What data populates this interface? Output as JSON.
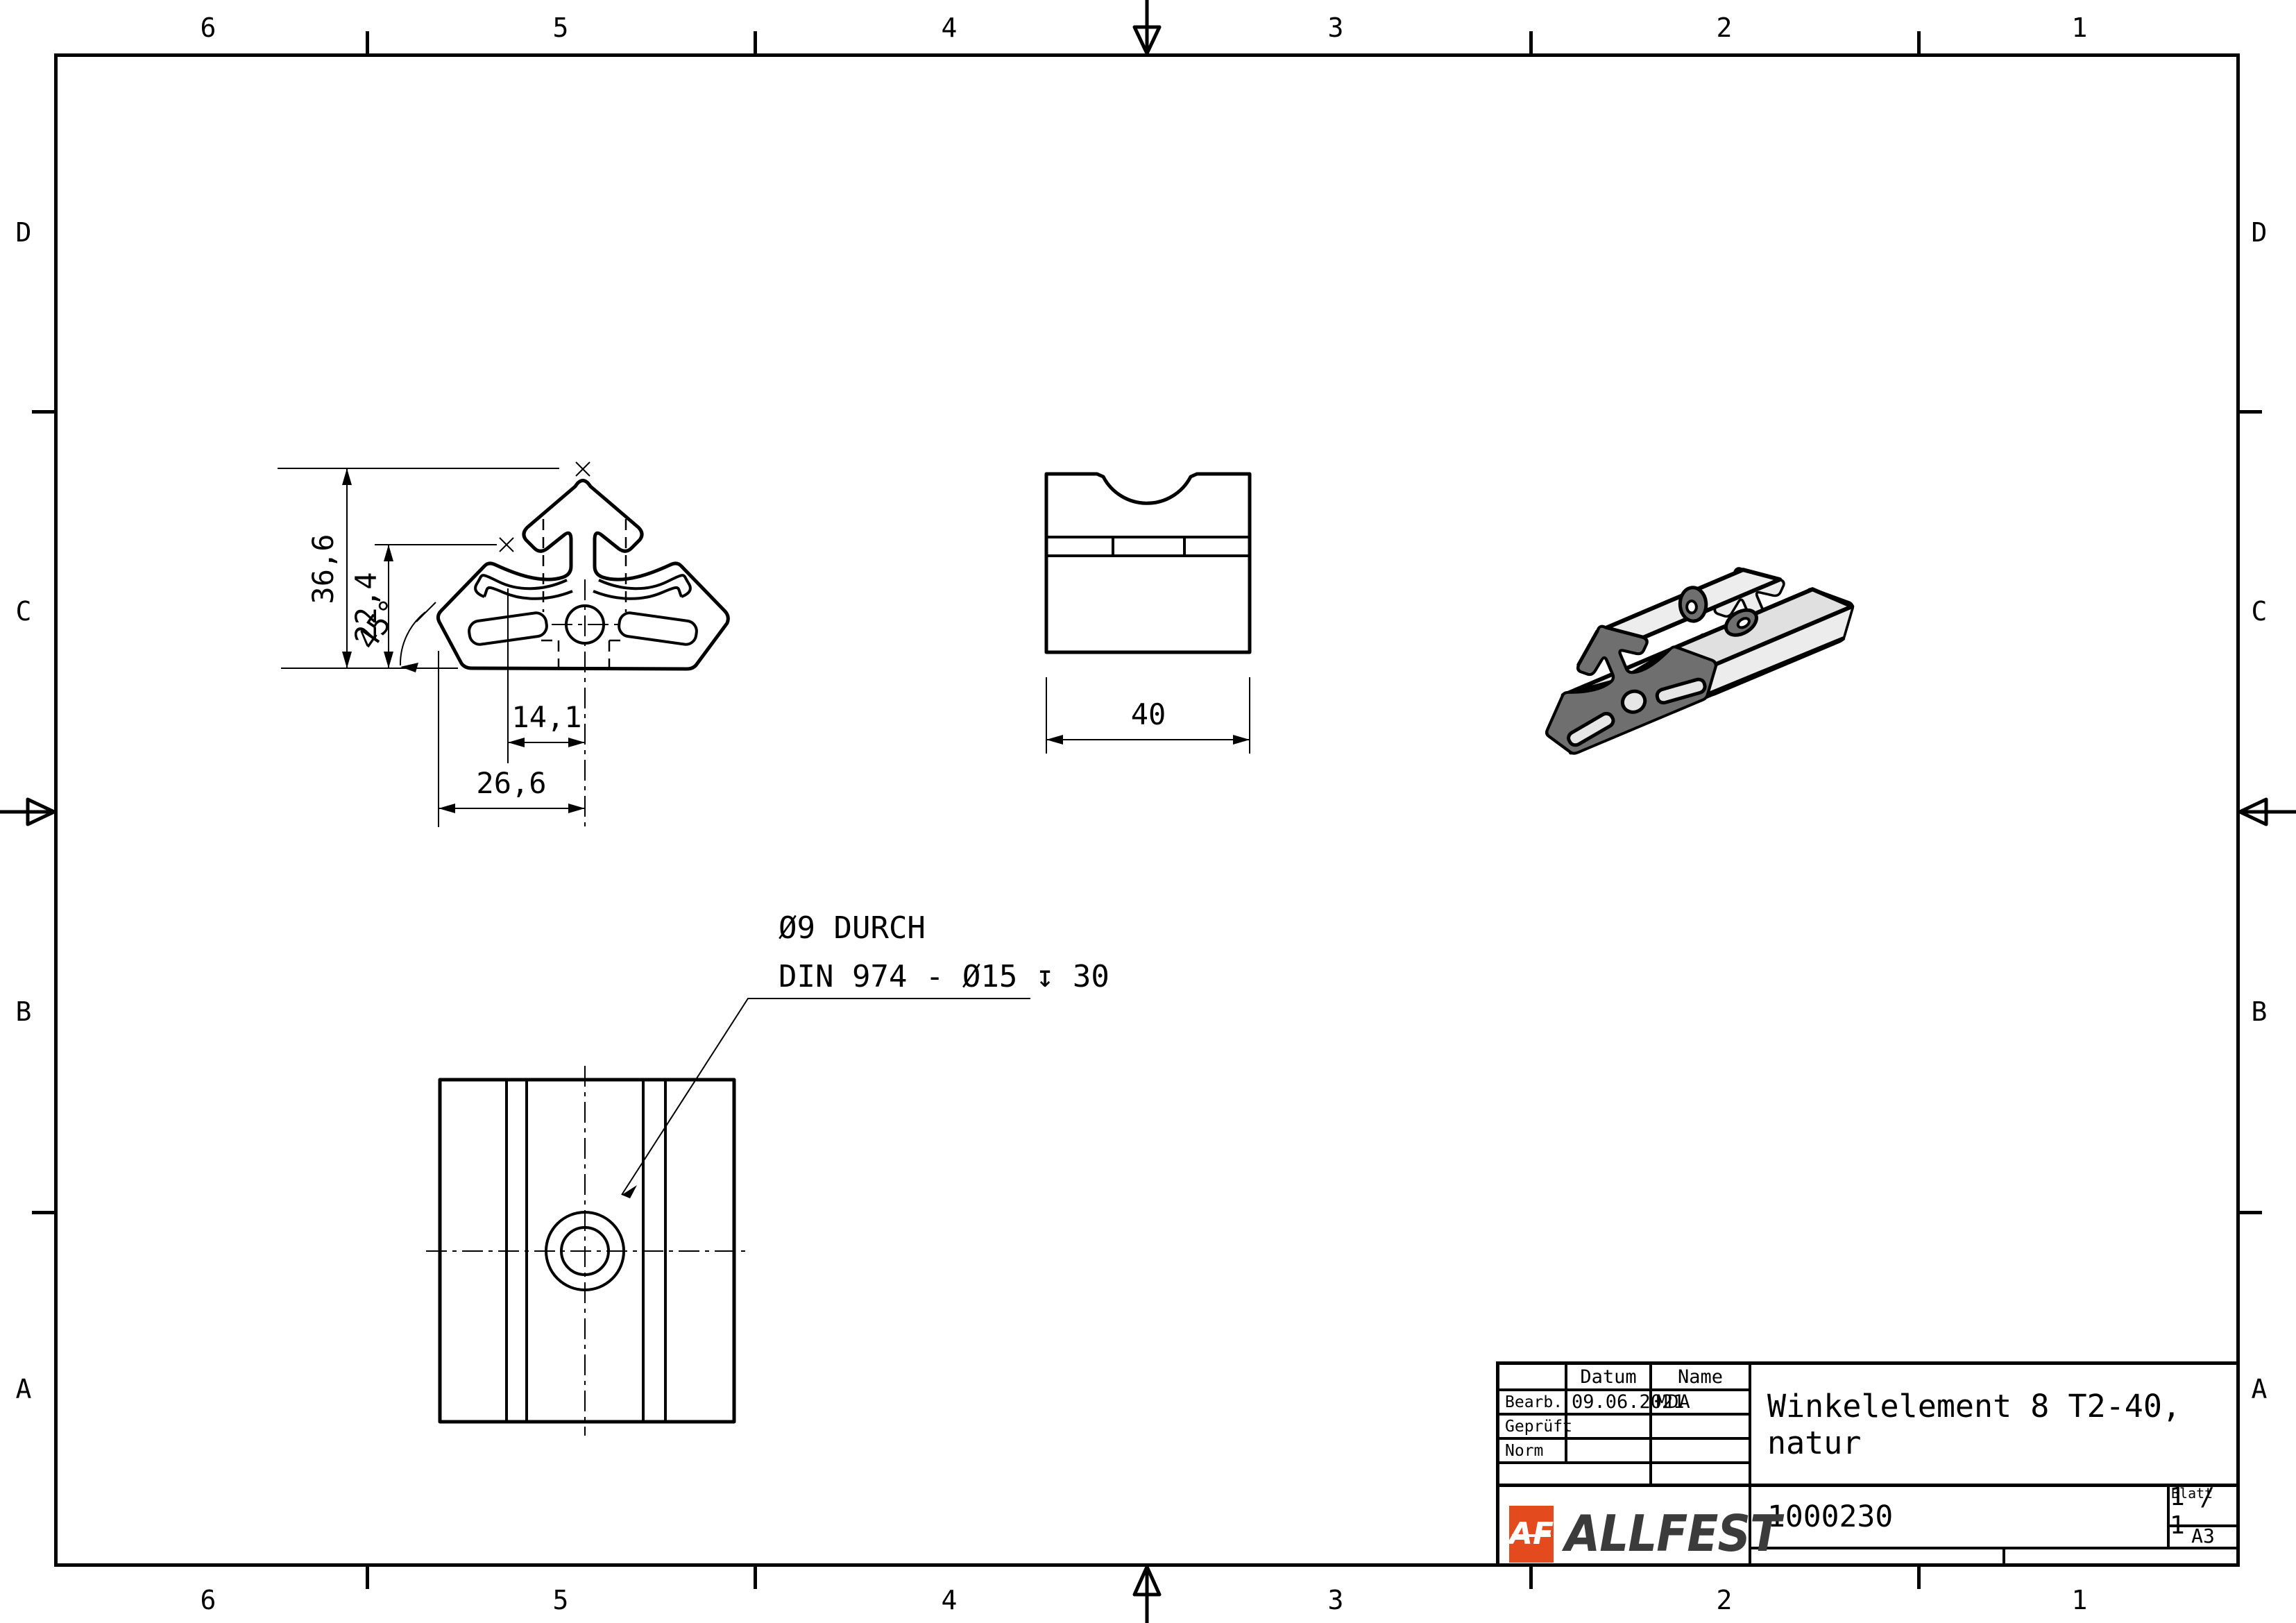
{
  "zones": {
    "columns": [
      "6",
      "5",
      "4",
      "3",
      "2",
      "1"
    ],
    "rows": [
      "D",
      "C",
      "B",
      "A"
    ]
  },
  "views": {
    "section": {
      "dims": {
        "h_total": "36,6",
        "h_slot": "22,4",
        "angle": "45°",
        "w_hole": "14,1",
        "w_total": "26,6"
      }
    },
    "front": {
      "dim_width": "40"
    },
    "bottom": {
      "callout_line1": "Ø9 DURCH",
      "callout_line2": "DIN 974 - Ø15 ↧ 30"
    }
  },
  "titleblock": {
    "headers": {
      "datum": "Datum",
      "name": "Name"
    },
    "rows": [
      {
        "label": "Bearb.",
        "datum": "09.06.2021",
        "name": "MDA"
      },
      {
        "label": "Geprüft",
        "datum": "",
        "name": ""
      },
      {
        "label": "Norm",
        "datum": "",
        "name": ""
      }
    ],
    "title": "Winkelelement 8 T2-40, natur",
    "part_number": "1000230",
    "sheet_label": "Blatt",
    "sheet": "1 / 1",
    "format": "A3",
    "logo": {
      "monogram": "AF",
      "name": "ALLFEST",
      "orange": "#E34A1E",
      "dark": "#3B3B3B"
    }
  },
  "iso": {
    "face_color": "#6F6F6F",
    "surface_color": "#E4E4E4"
  }
}
